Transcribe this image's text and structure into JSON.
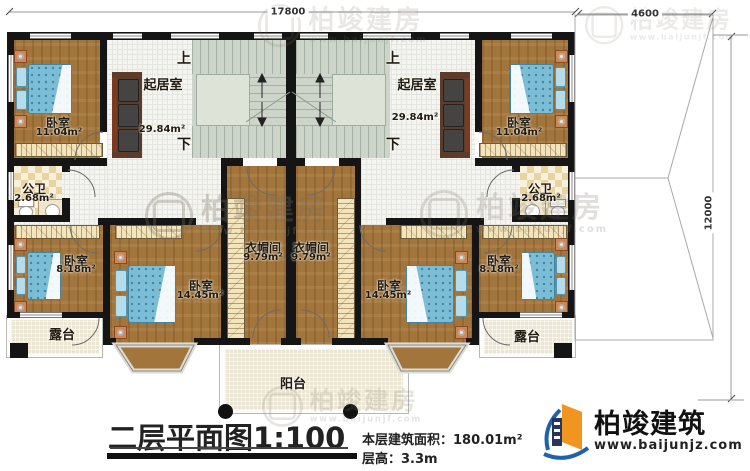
{
  "dimensions": {
    "total_width": "17800",
    "right_wing_width": "4600",
    "total_depth": "12000"
  },
  "rooms": {
    "living": {
      "name": "起居室",
      "area": "29.84m²"
    },
    "bedroom_top": {
      "name": "卧室",
      "area": "11.04m²"
    },
    "bathroom": {
      "name": "公卫",
      "area": "2.68m²"
    },
    "bedroom_small": {
      "name": "卧室",
      "area": "8.18m²"
    },
    "bedroom_large": {
      "name": "卧室",
      "area": "14.45m²"
    },
    "cloakroom": {
      "name": "衣帽间",
      "area": "9.79m²"
    },
    "terrace": {
      "name": "露台"
    },
    "balcony": {
      "name": "阳台"
    }
  },
  "stairs": {
    "up_label": "上",
    "down_label": "下"
  },
  "footer": {
    "title": "二层平面图",
    "scale": "1:100",
    "area_label": "本层建筑面积：",
    "area_value": "180.01m²",
    "height_label": "层高：",
    "height_value": "3.3m"
  },
  "brand": {
    "name": "柏竣建筑",
    "website": "www.baijunjz.com"
  },
  "watermark": {
    "text": "柏竣建房",
    "website": "www.baijunjf.com"
  }
}
